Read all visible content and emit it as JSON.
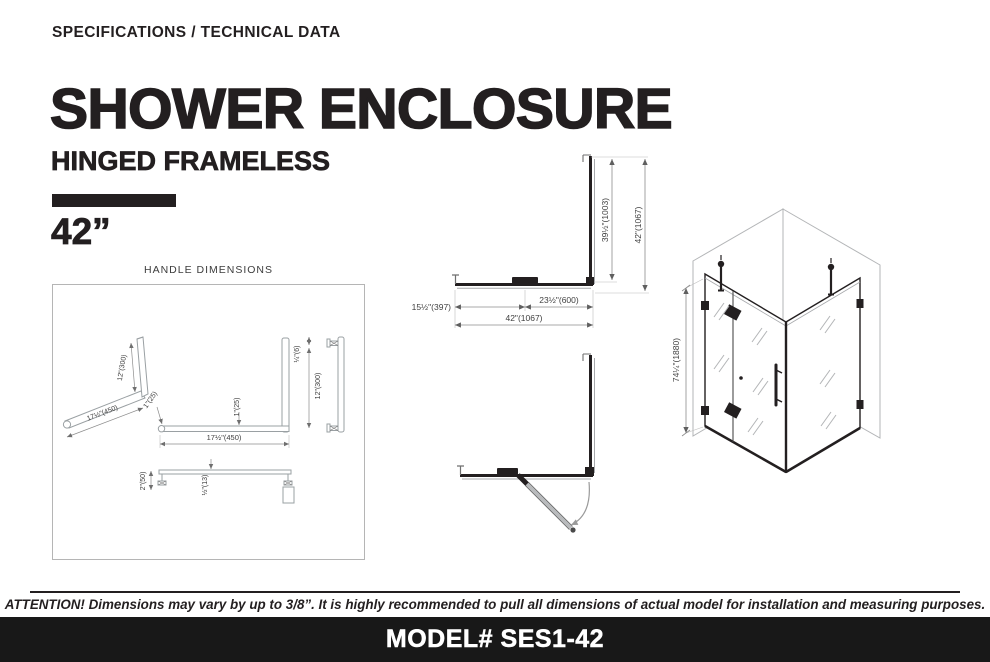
{
  "header": {
    "eyebrow": "SPECIFICATIONS / TECHNICAL DATA",
    "title": "SHOWER ENCLOSURE",
    "subtitle": "HINGED FRAMELESS",
    "size_label": "42”"
  },
  "handle_box": {
    "title": "HANDLE DIMENSIONS",
    "labels": {
      "iso_height": "12\"(300)",
      "iso_length": "17½\"(450)",
      "front_thickness_a": "1\"(25)",
      "front_thickness_b": "1\"(25)",
      "front_length": "17½\"(450)",
      "side_gap": "¼\"(6)",
      "side_height": "12\"(300)",
      "top_standoff": "2\"(50)",
      "top_thickness": "½\"(13)"
    }
  },
  "plan": {
    "labels": {
      "inner_depth": "39½\"(1003)",
      "outer_depth": "42\"(1067)",
      "door_width": "15½\"(397)",
      "panel_width": "23½\"(600)",
      "total_width": "42\"(1067)"
    }
  },
  "iso": {
    "height_label": "74¼\"(1880)"
  },
  "footer": {
    "attention": "ATTENTION! Dimensions may vary by up to 3/8”. It is highly recommended to pull all dimensions of actual model for installation and measuring purposes.",
    "model": "MODEL# SES1-42"
  },
  "colors": {
    "ink": "#231f20",
    "line_gray": "#9aa0a3",
    "footer_bg": "#181818"
  }
}
